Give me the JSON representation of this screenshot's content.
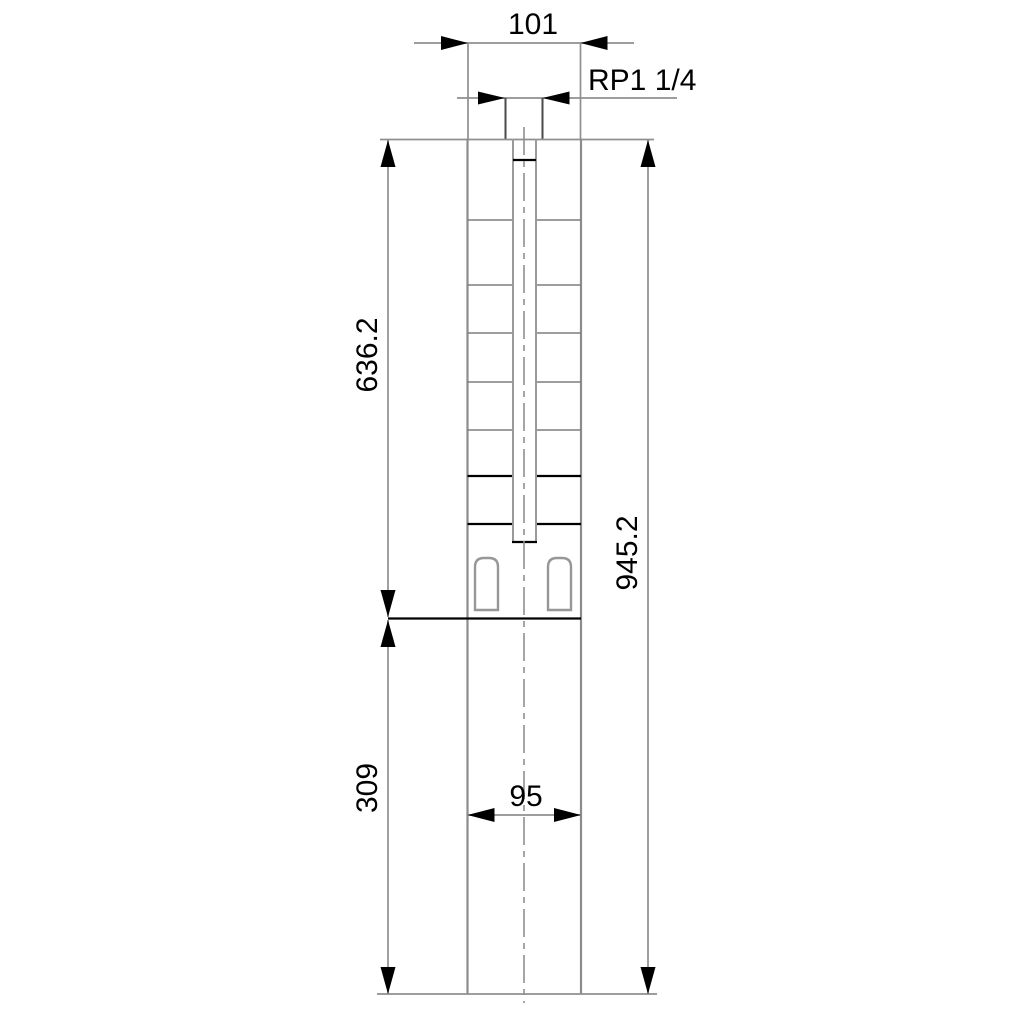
{
  "drawing": {
    "labels": {
      "width_top": "101",
      "thread": "RP1 1/4",
      "length_upper": "636.2",
      "length_total": "945.2",
      "length_lower": "309",
      "width_lower": "95"
    },
    "colors": {
      "background": "#ffffff",
      "line_gray": "#8f8f8f",
      "line_black": "#000000"
    }
  }
}
